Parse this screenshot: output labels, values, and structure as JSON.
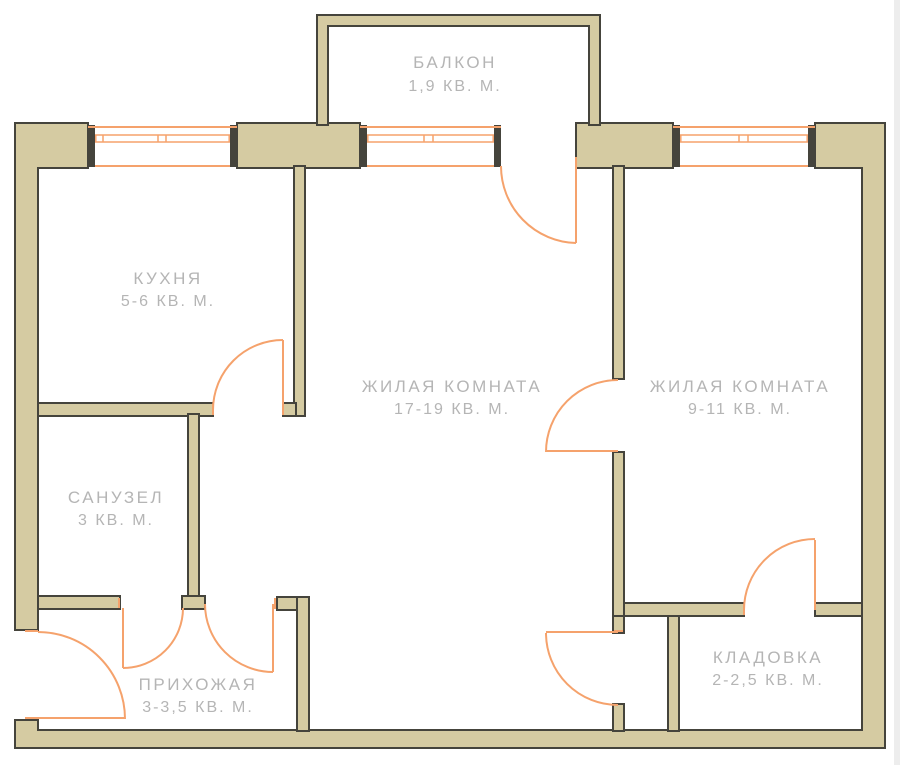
{
  "colors": {
    "wall_fill": "#d5cba2",
    "wall_outline": "#45443c",
    "doors_windows": "#f5a26c",
    "label_text": "#b5b5b5",
    "background": "#ffffff"
  },
  "rooms": {
    "balcony": {
      "name": "БАЛКОН",
      "area": "1,9 КВ. М."
    },
    "kitchen": {
      "name": "КУХНЯ",
      "area": "5-6 КВ. М."
    },
    "bathroom": {
      "name": "САНУЗЕЛ",
      "area": "3 КВ. М."
    },
    "hallway": {
      "name": "ПРИХОЖАЯ",
      "area": "3-3,5 КВ. М."
    },
    "living_room_1": {
      "name": "ЖИЛАЯ КОМНАТА",
      "area": "17-19 КВ. М."
    },
    "living_room_2": {
      "name": "ЖИЛАЯ КОМНАТА",
      "area": "9-11 КВ. М."
    },
    "storage": {
      "name": "КЛАДОВКА",
      "area": "2-2,5 КВ. М."
    }
  }
}
